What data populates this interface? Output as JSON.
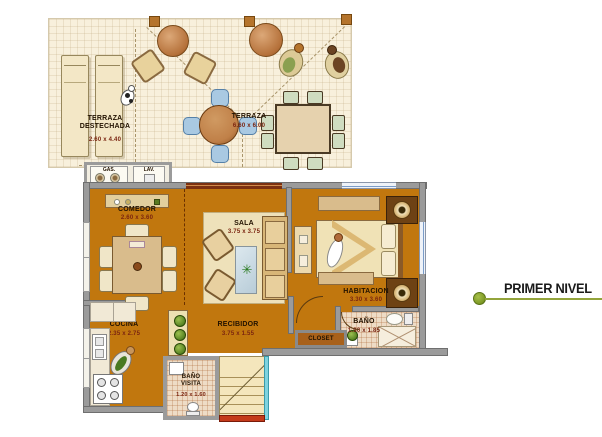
{
  "legend": {
    "title": "PRIMER NIVEL",
    "accent_color": "#7f9b27"
  },
  "terrace": {
    "destechada_line1": "TERRAZA",
    "destechada_line2": "DESTECHADA",
    "destechada_dims": "2.60 x 4.40",
    "name": "TERRAZA",
    "dims": "6.60 x 6.00"
  },
  "utility": {
    "gas": "GAS.",
    "lav": "LAV."
  },
  "rooms": {
    "comedor": {
      "name": "COMEDOR",
      "dims": "2.60 x 3.60"
    },
    "sala": {
      "name": "SALA",
      "dims": "3.75 x 3.75"
    },
    "habitacion": {
      "name": "HABITACION",
      "dims": "3.30 x 3.60"
    },
    "cocina": {
      "name": "COCINA",
      "dims": "2.35 x 2.75"
    },
    "recibidor": {
      "name": "RECIBIDOR",
      "dims": "3.75 x 1.55"
    },
    "bano": {
      "name": "BAÑO",
      "dims": "1.90 x 1.85"
    },
    "closet": {
      "name": "CLOSET"
    },
    "bano_visita": {
      "line1": "BAÑO",
      "line2": "VISITA",
      "dims": "1.20 x 1.60"
    }
  },
  "icons": {
    "plant": "✳"
  },
  "colors": {
    "floor": "#c1770e",
    "terrace": "#f8f0dc",
    "wall": "#9b9b9b",
    "window": "#a9c6e8",
    "sliding_door": "#7c3010",
    "stairs_red": "#c43a1a",
    "stairs_cyan": "#7fd3df",
    "legend_accent": "#7f9b27"
  }
}
